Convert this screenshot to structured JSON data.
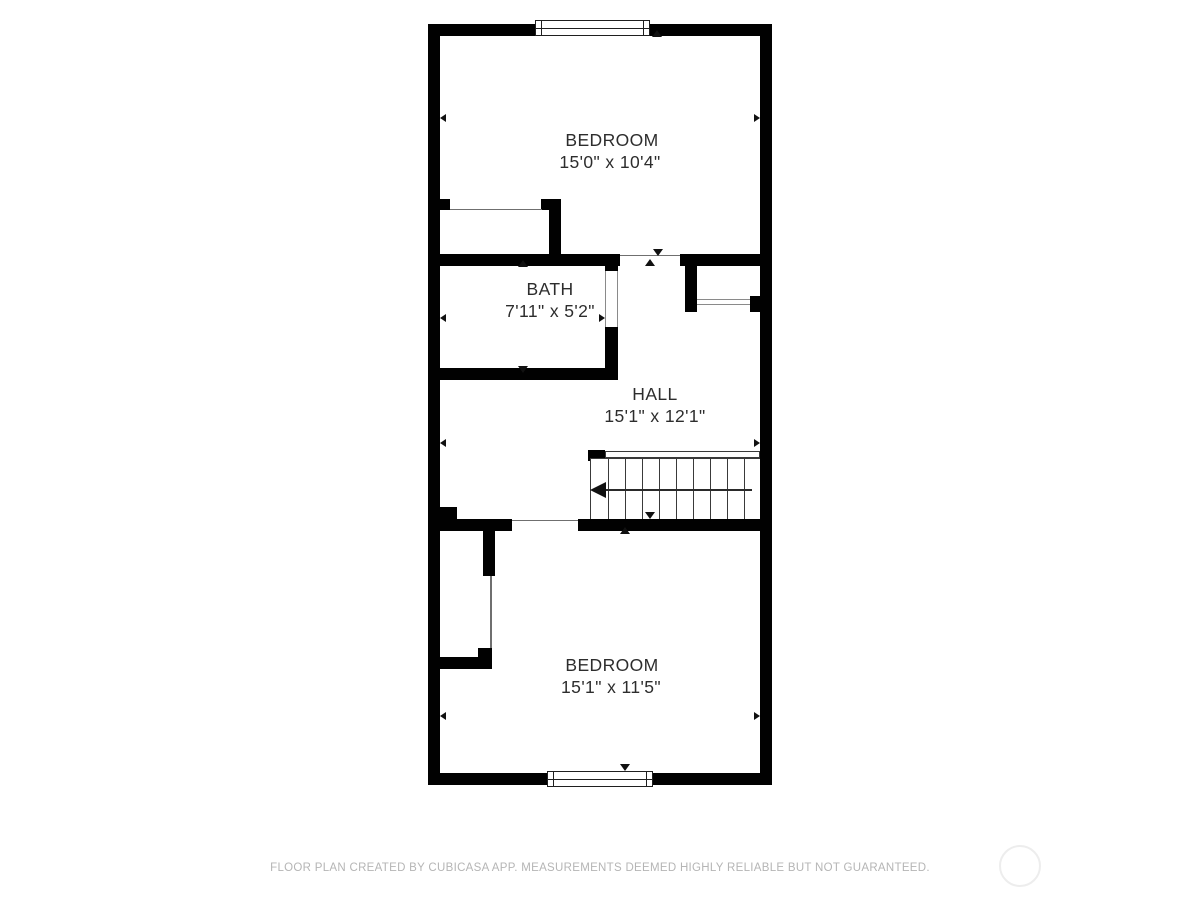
{
  "title": "Floor plan",
  "rooms": [
    {
      "name": "BEDROOM",
      "dims": "15'0\" x 10'4\""
    },
    {
      "name": "BATH",
      "dims": "7'11\" x 5'2\""
    },
    {
      "name": "HALL",
      "dims": "15'1\" x 12'1\""
    },
    {
      "name": "BEDROOM",
      "dims": "15'1\" x 11'5\""
    }
  ],
  "stairs": {
    "direction": "left"
  },
  "footer": {
    "disclaimer": "FLOOR PLAN CREATED BY CUBICASA APP. MEASUREMENTS DEEMED HIGHLY RELIABLE BUT NOT GUARANTEED."
  },
  "colors": {
    "wall": "#010101",
    "room_text": "#2d2d2d",
    "footer_text": "#b5b5b5",
    "watermark_ring": "#ededed",
    "background": "#ffffff"
  }
}
